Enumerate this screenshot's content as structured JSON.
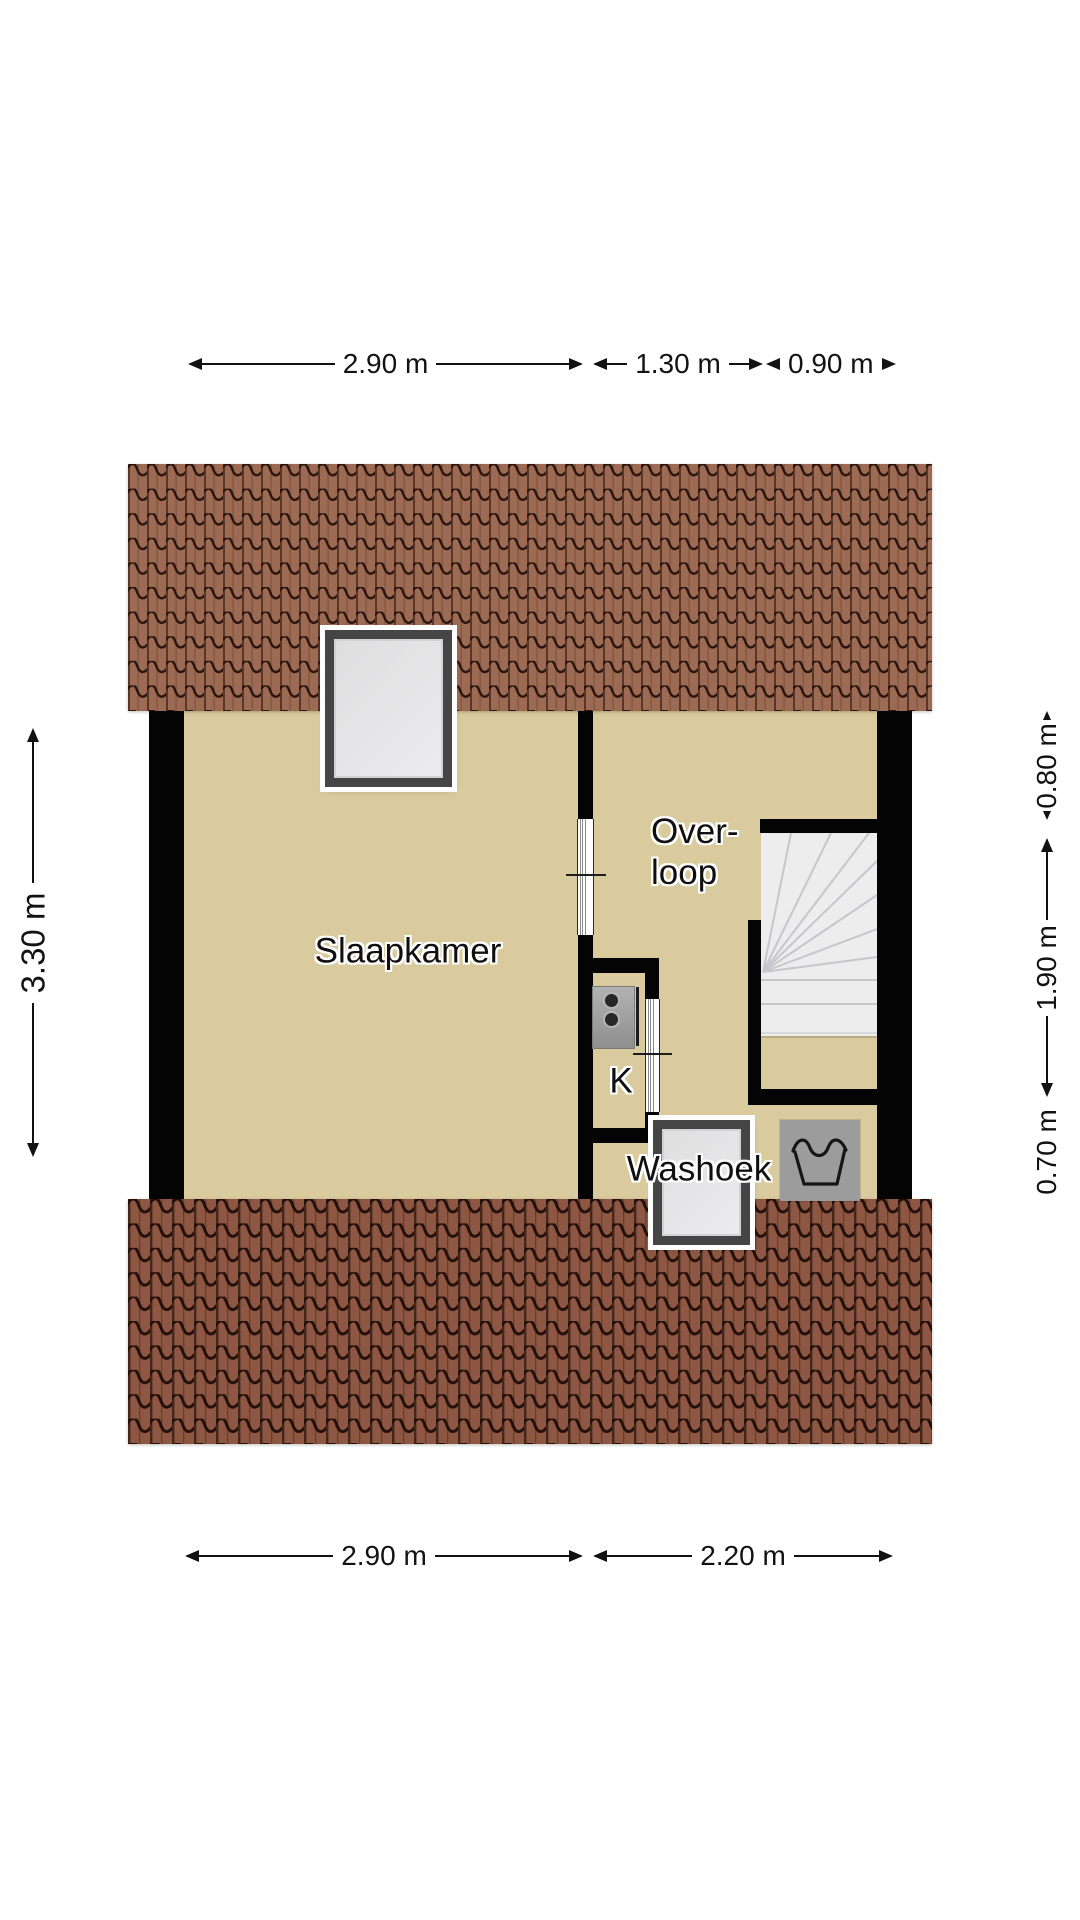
{
  "plan": {
    "rooms": {
      "slaapkamer": "Slaapkamer",
      "overloop_line1": "Over-",
      "overloop_line2": "loop",
      "kast": "K",
      "washoek": "Washoek"
    },
    "dimensions": {
      "top_left": "2.90 m",
      "top_middle": "1.30 m",
      "top_right": "0.90 m",
      "left_height": "3.30 m",
      "right_top": "0.80 m",
      "right_middle": "1.90 m",
      "right_bottom": "0.70 m",
      "bottom_left": "2.90 m",
      "bottom_right": "2.20 m"
    },
    "icons": {
      "boiler": "boiler-appliance-icon",
      "laundry": "laundry-wash-tub-icon",
      "skylight": "skylight-window",
      "washoek_window": "window",
      "stairs": "winder-staircase"
    },
    "colors": {
      "floor": "#d9cb9d",
      "wall": "#040404",
      "roof_top_tile": "#9d6b53",
      "roof_bottom_tile": "#8d5743",
      "stairs": "#ededee",
      "appliance_gray": "#9c9c9c"
    }
  }
}
